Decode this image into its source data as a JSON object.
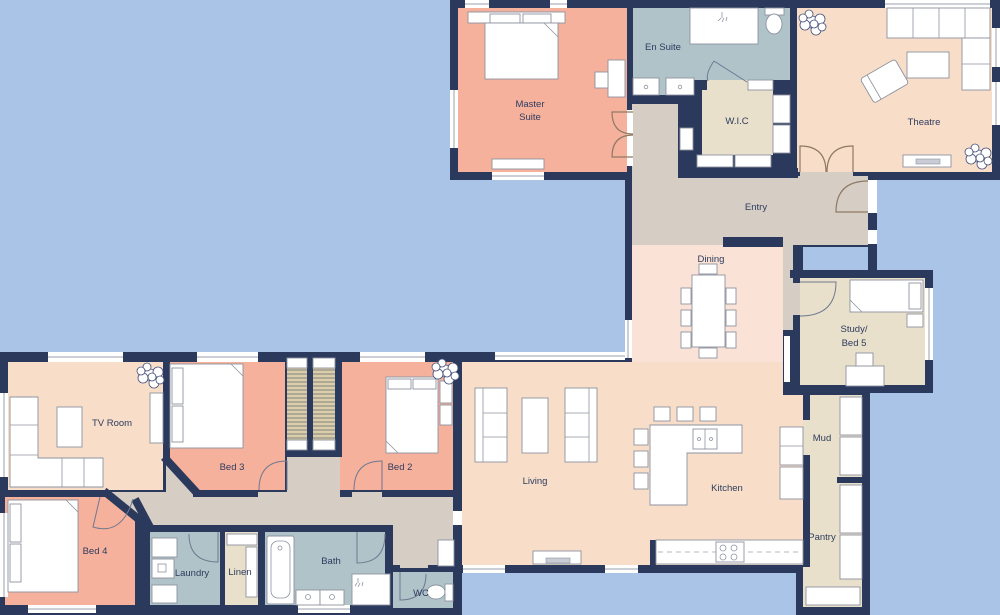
{
  "palette": {
    "background": "#A9C4E7",
    "wall": "#2B3A5C",
    "bedroom": "#F6B19D",
    "living_area": "#F8DDC9",
    "dining_area": "#FAE3D6",
    "hall": "#D6CDC5",
    "bathroom": "#AFC3C9",
    "storage": "#E9E0CC",
    "wardrobe": "#DACDA8",
    "label": "#2E3C5E"
  },
  "rooms": {
    "master_suite": {
      "line1": "Master",
      "line2": "Suite"
    },
    "en_suite": "En Suite",
    "wic": "W.I.C",
    "theatre": "Theatre",
    "entry": "Entry",
    "dining": "Dining",
    "study": {
      "line1": "Study/",
      "line2": "Bed 5"
    },
    "mud": "Mud",
    "pantry": "Pantry",
    "tv_room": "TV Room",
    "bed2": "Bed 2",
    "bed3": "Bed 3",
    "bed4": "Bed 4",
    "living": "Living",
    "kitchen": "Kitchen",
    "laundry": "Laundry",
    "linen": "Linen",
    "bath": "Bath",
    "wc": "WC"
  }
}
